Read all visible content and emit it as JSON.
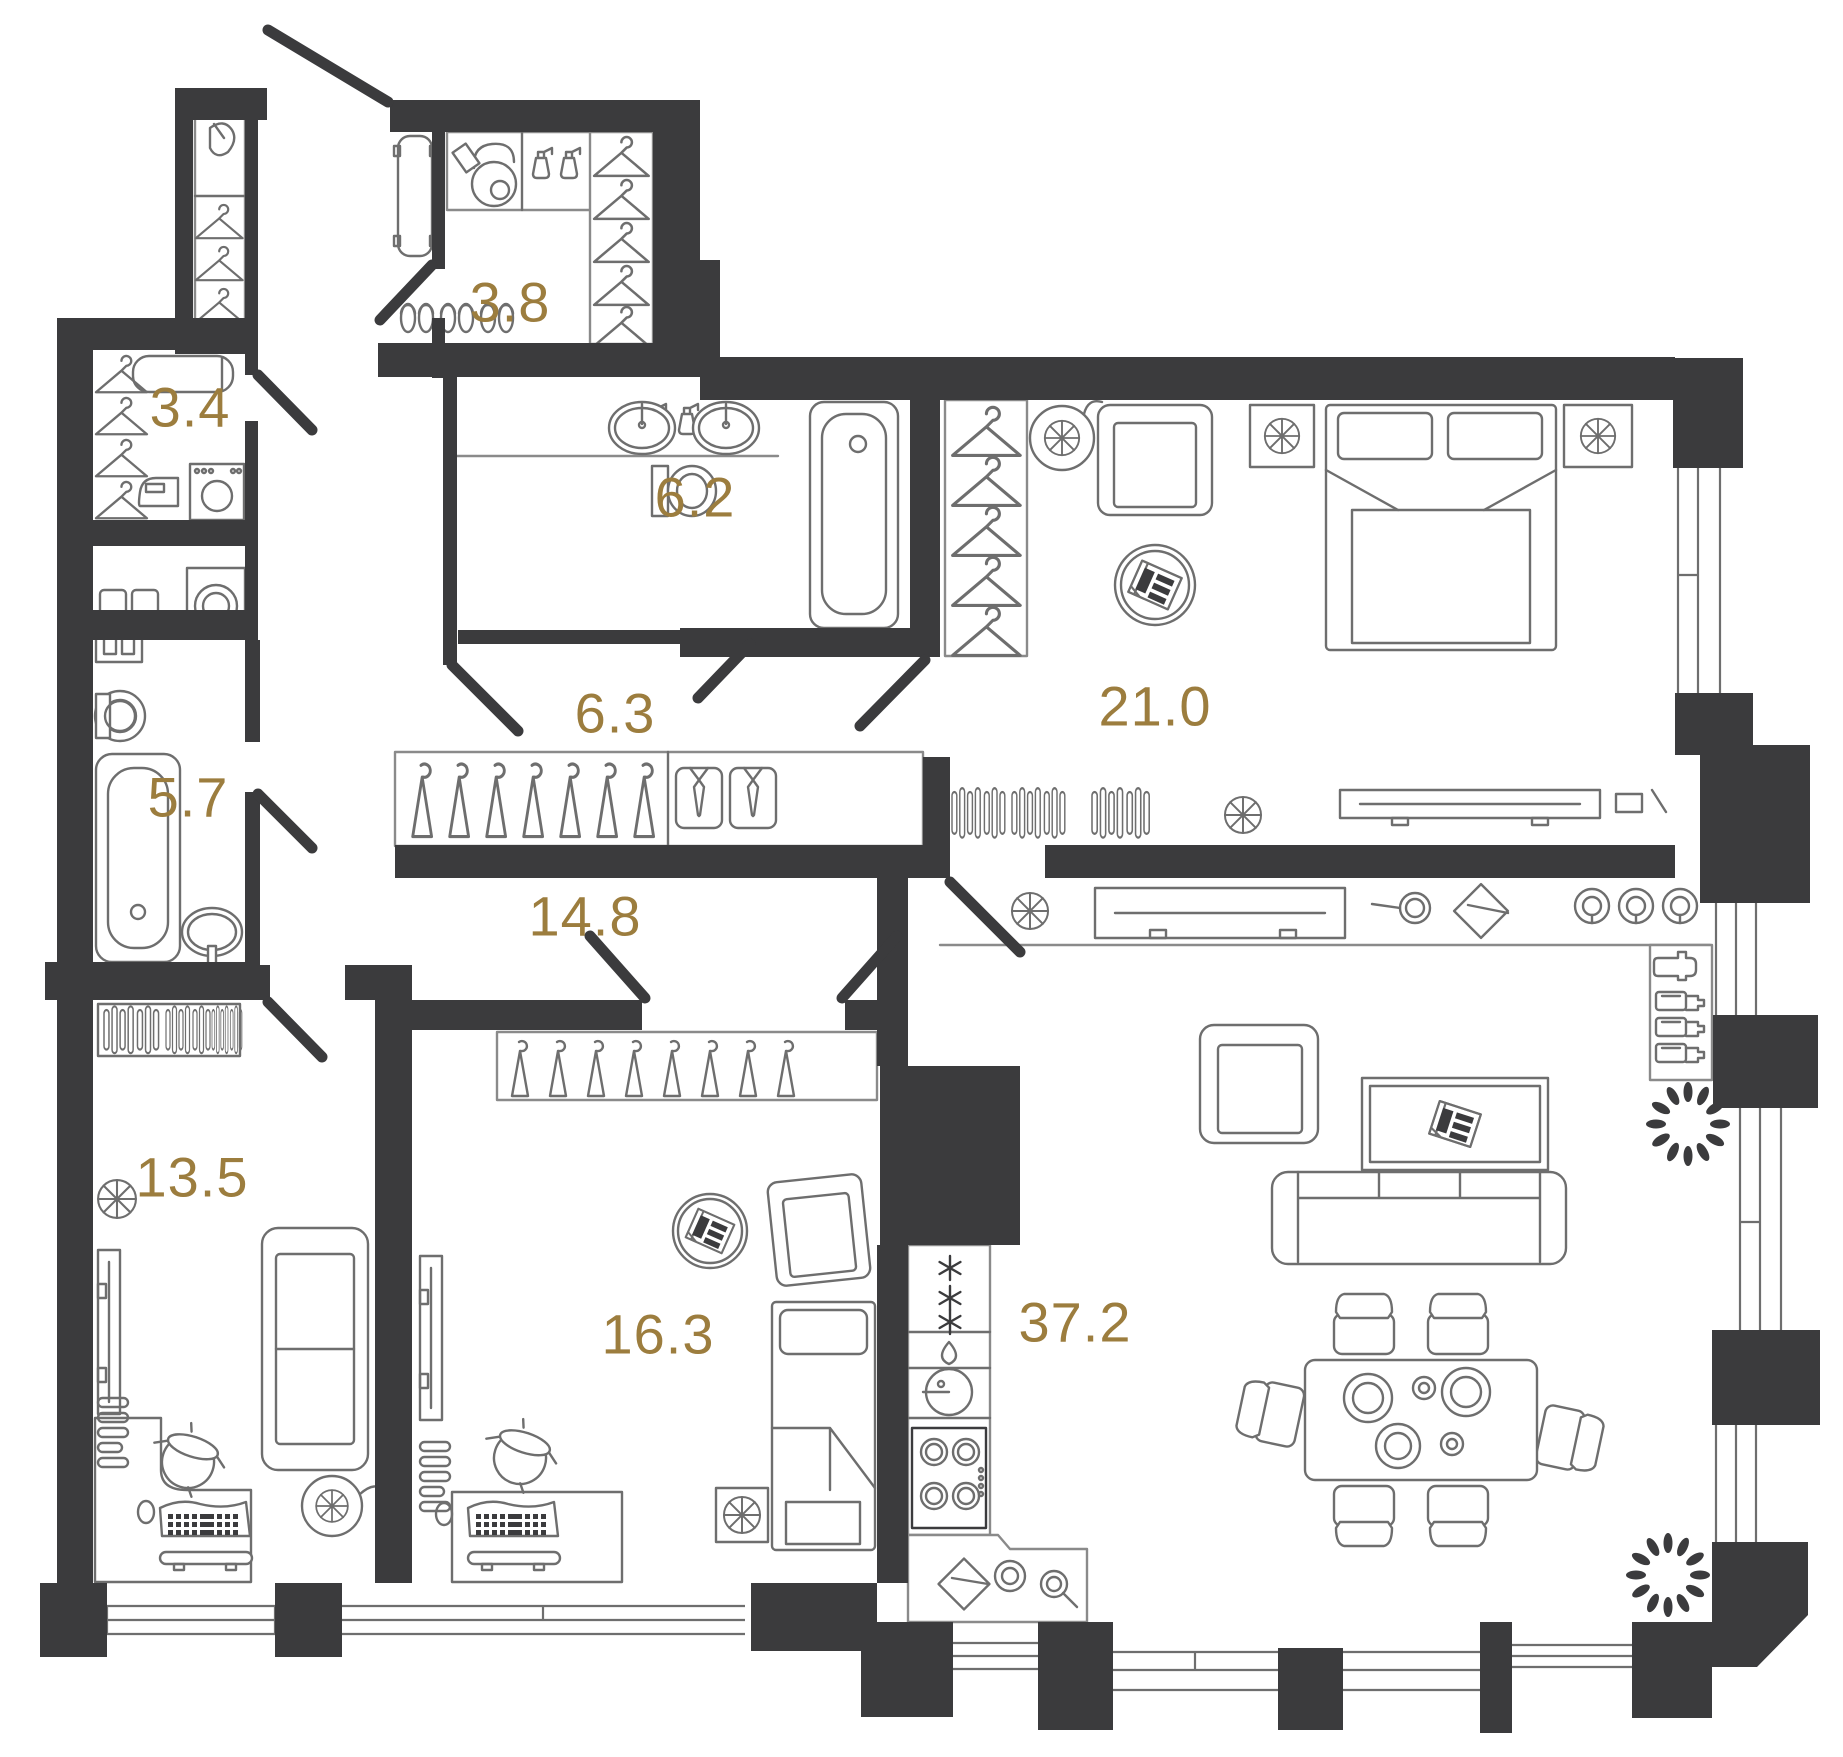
{
  "colors": {
    "wall": "#3b3b3d",
    "furniture_line": "#6e6e6e",
    "area_label": "#9c7d3e",
    "background": "#ffffff"
  },
  "rooms": [
    {
      "id": "entry-wardrobe",
      "area": "3.8",
      "furniture": [
        "bench",
        "vacuum-cleaner",
        "spray-bottles",
        "hangers",
        "slippers"
      ]
    },
    {
      "id": "hall-closet",
      "area": "3.4",
      "furniture": [
        "hangers",
        "ironing-board",
        "iron",
        "washing-machine"
      ]
    },
    {
      "id": "bathroom-main",
      "area": "6.2",
      "furniture": [
        "spray-bottles",
        "double-sink",
        "toilet",
        "bathtub"
      ]
    },
    {
      "id": "corridor",
      "area": "6.3",
      "furniture": [
        "wardrobe-hangers",
        "shirts-with-ties"
      ]
    },
    {
      "id": "bedroom",
      "area": "21.0",
      "furniture": [
        "closet-hangers",
        "fan",
        "armchair",
        "newspaper-table",
        "double-bed",
        "nightstands",
        "radiators",
        "tv-console"
      ]
    },
    {
      "id": "bathroom-second",
      "area": "5.7",
      "furniture": [
        "cabinet",
        "toilet",
        "bathtub",
        "sink",
        "washing-machine",
        "shelf"
      ]
    },
    {
      "id": "hallway",
      "area": "14.8",
      "furniture": []
    },
    {
      "id": "room-west",
      "area": "13.5",
      "furniture": [
        "radiator",
        "tv",
        "sofa",
        "corner-desk",
        "kettle",
        "keyboard",
        "fan"
      ]
    },
    {
      "id": "room-middle",
      "area": "16.3",
      "furniture": [
        "wardrobe-hangers",
        "newspaper-table",
        "armchair",
        "single-bed",
        "fan-box",
        "tv",
        "desk",
        "kettle",
        "keyboard"
      ]
    },
    {
      "id": "living-kitchen",
      "area": "37.2",
      "furniture": [
        "kitchen-column",
        "fridge",
        "sink",
        "hob",
        "counter",
        "bar-bottles",
        "shaker",
        "armchair",
        "coffee-table",
        "sofa",
        "dining-table",
        "chairs",
        "plants"
      ]
    }
  ]
}
